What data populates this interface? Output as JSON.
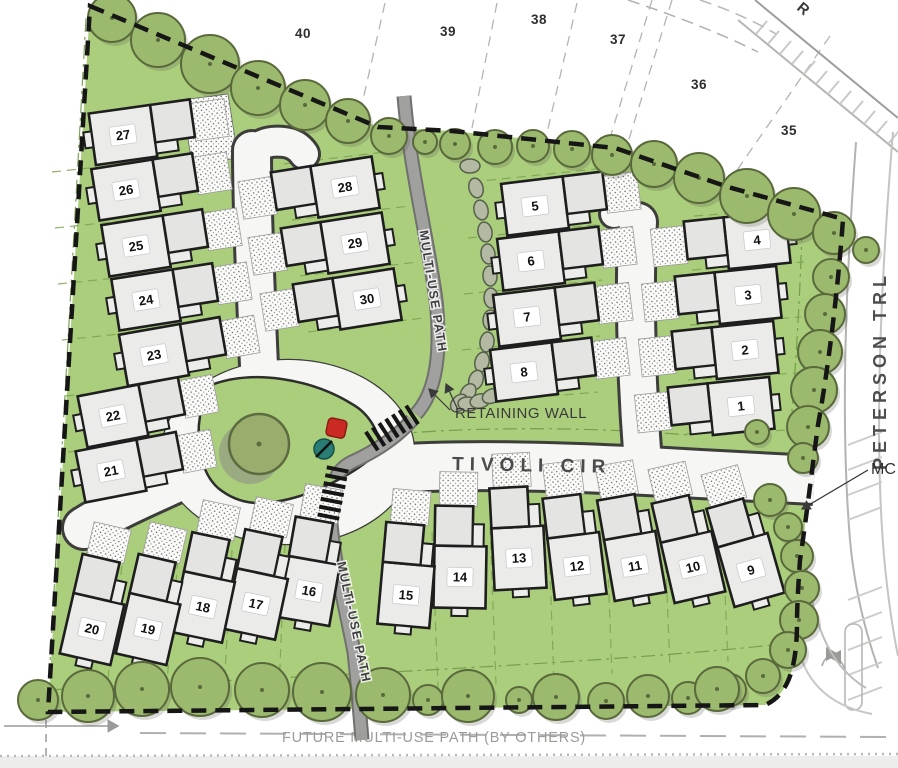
{
  "plan": {
    "streets": {
      "tivoli": "TIVOLI CIR",
      "peterson": "PETERSON TRL",
      "offsite_road_partial": "R"
    },
    "paths": {
      "upper_label": "MULTI-USE PATH",
      "lower_label": "MULTI-USE PATH",
      "future_label": "FUTURE MULTI-USE PATH (BY OTHERS)"
    },
    "annotations": {
      "retaining_wall": "RETAINING WALL",
      "mc_partial": "MC"
    },
    "lots": [
      "1",
      "2",
      "3",
      "4",
      "5",
      "6",
      "7",
      "8",
      "9",
      "10",
      "11",
      "12",
      "13",
      "14",
      "15",
      "16",
      "17",
      "18",
      "19",
      "20",
      "21",
      "22",
      "23",
      "24",
      "25",
      "26",
      "27",
      "28",
      "29",
      "30"
    ],
    "offsite_parcels": [
      "40",
      "39",
      "38",
      "37",
      "36",
      "35"
    ],
    "colors": {
      "site_green": "#abce7d",
      "tree_green": "#9cba6e",
      "tree_outline": "#5a693c",
      "road_fill": "#f6f6f4",
      "road_casing": "#3d3d3b",
      "path_gray": "#a0a09e",
      "house_fill": "#ebebe9",
      "outline_black": "#1e1e1e",
      "label_gray": "#4b4b4b",
      "red_marker": "#cb2a22",
      "teal_marker": "#2a7d74",
      "wall_fill": "#b3b9a2"
    }
  }
}
